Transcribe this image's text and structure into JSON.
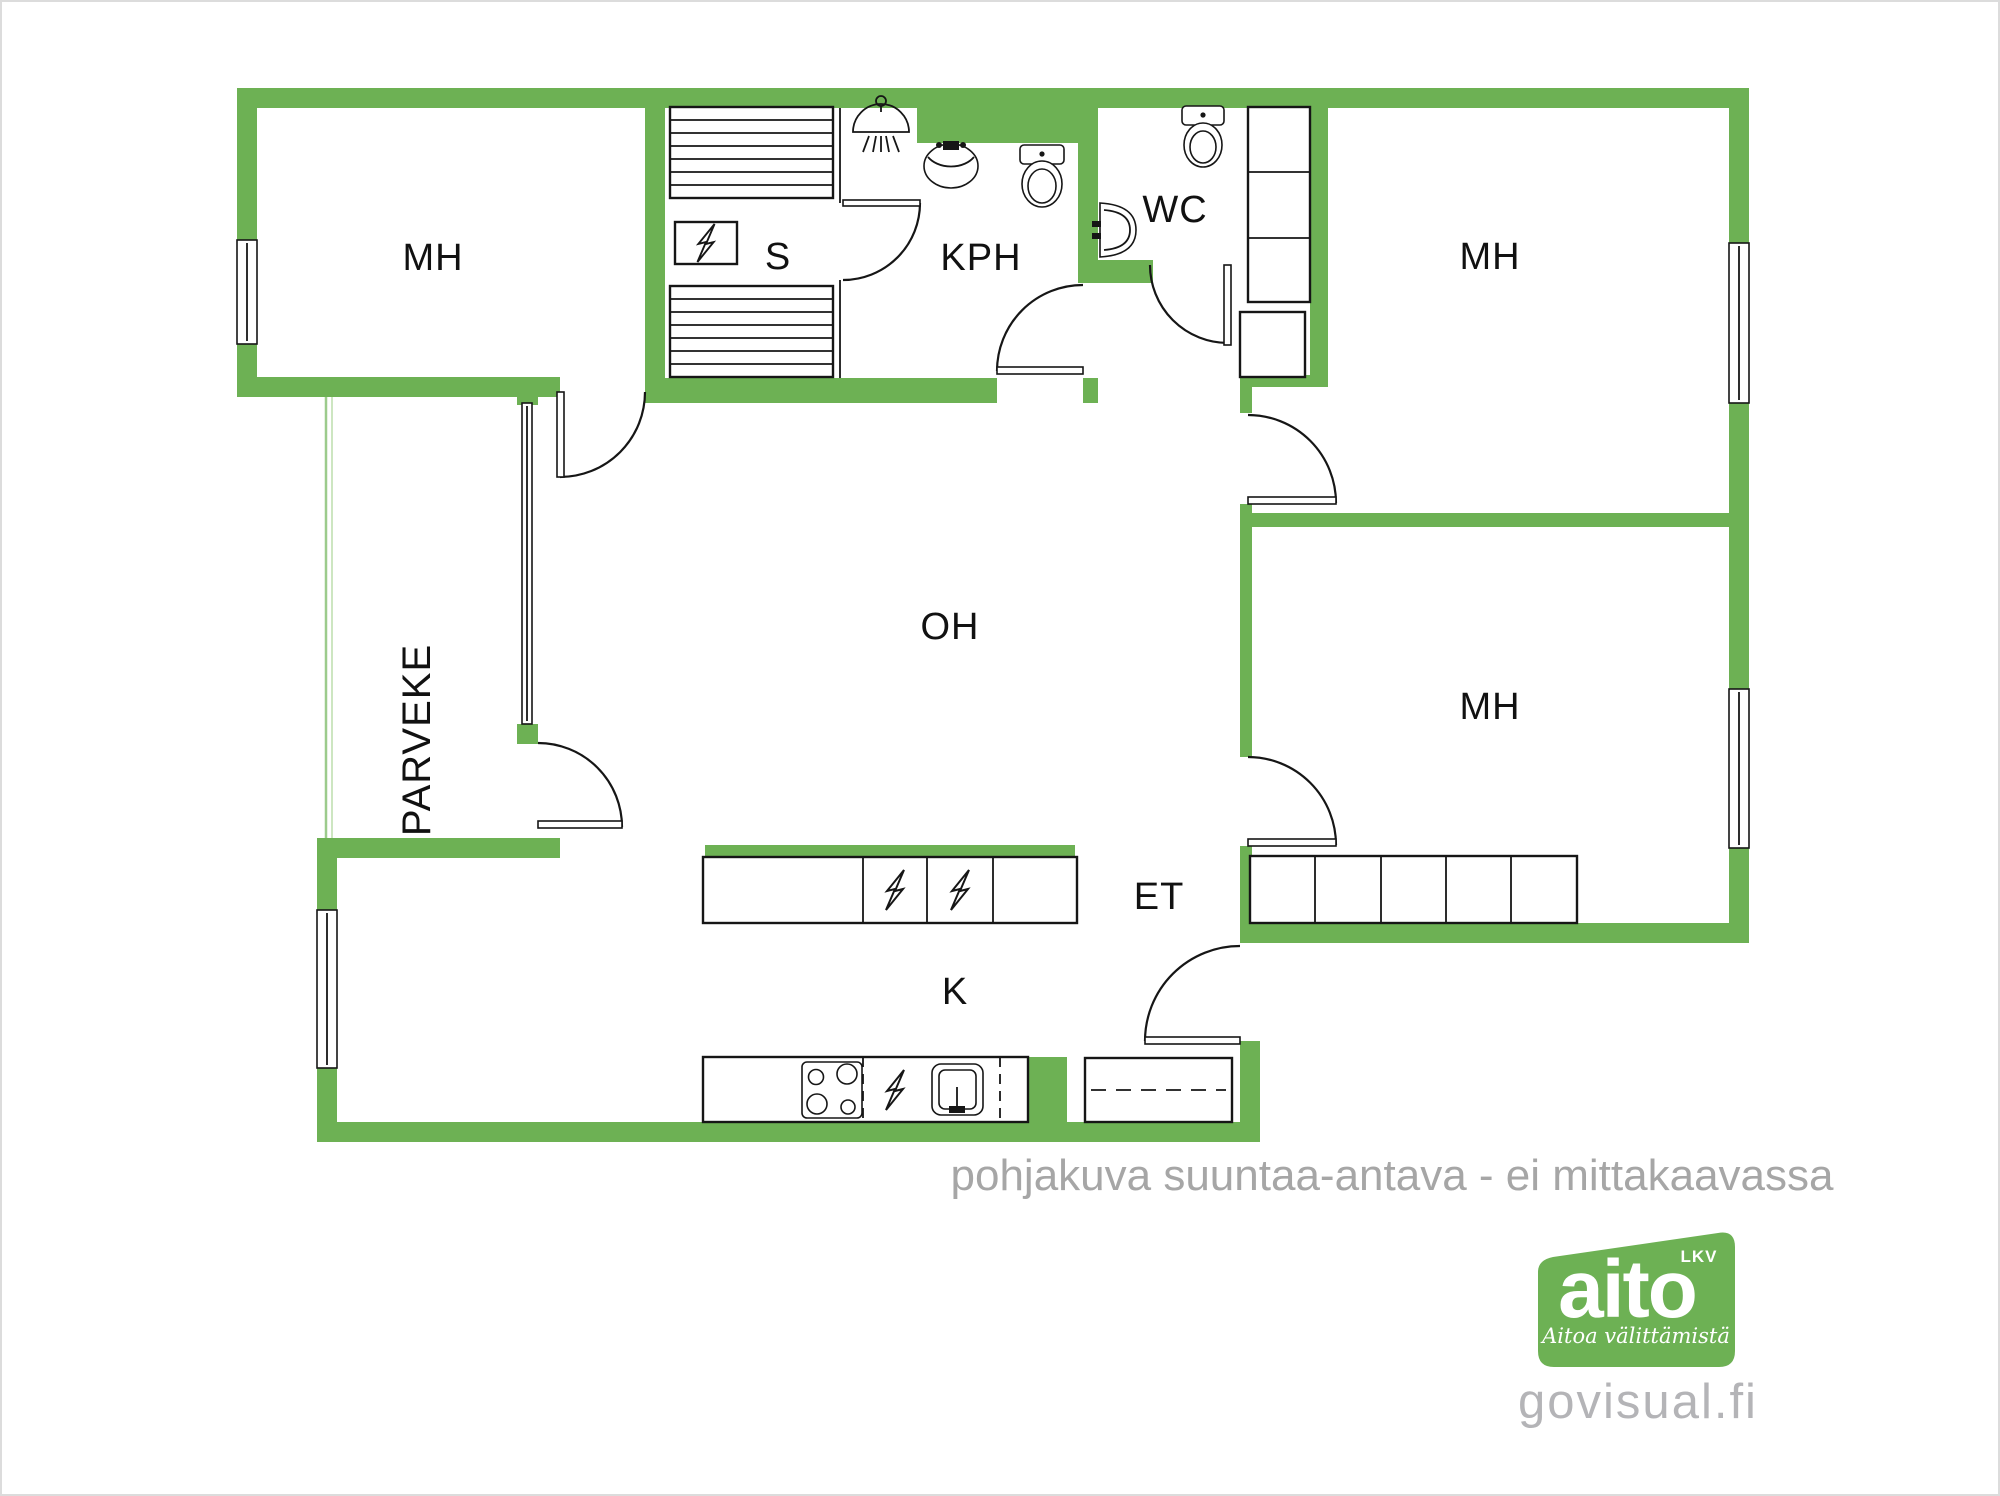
{
  "plan": {
    "rooms": {
      "mh_left": "MH",
      "sauna": "S",
      "kph": "KPH",
      "wc": "WC",
      "mh_top_right": "MH",
      "mh_mid_right": "MH",
      "oh": "OH",
      "et": "ET",
      "kitchen": "K",
      "parveke": "PARVEKE"
    },
    "colors": {
      "wall_green": "#6db154",
      "balcony_line_green": "#a9d49b",
      "label_black": "#111111",
      "footer_gray": "#a6a6a6",
      "brand_gray": "#b4b4b7"
    },
    "fixtures": [
      "sauna-benches",
      "sauna-stove",
      "shower",
      "washbasin",
      "toilet",
      "corner-washbasin",
      "wardrobe",
      "duct-shaft",
      "kitchen-counter",
      "hob",
      "kitchen-sink",
      "hallway-closet",
      "bedroom-closet"
    ]
  },
  "footer": {
    "disclaimer": "pohjakuva suuntaa-antava - ei mittakaavassa"
  },
  "branding": {
    "logo_text": "aito",
    "logo_lkv": "LKV",
    "tagline": "Aitoa välittämistä",
    "website": "govisual.fi"
  }
}
